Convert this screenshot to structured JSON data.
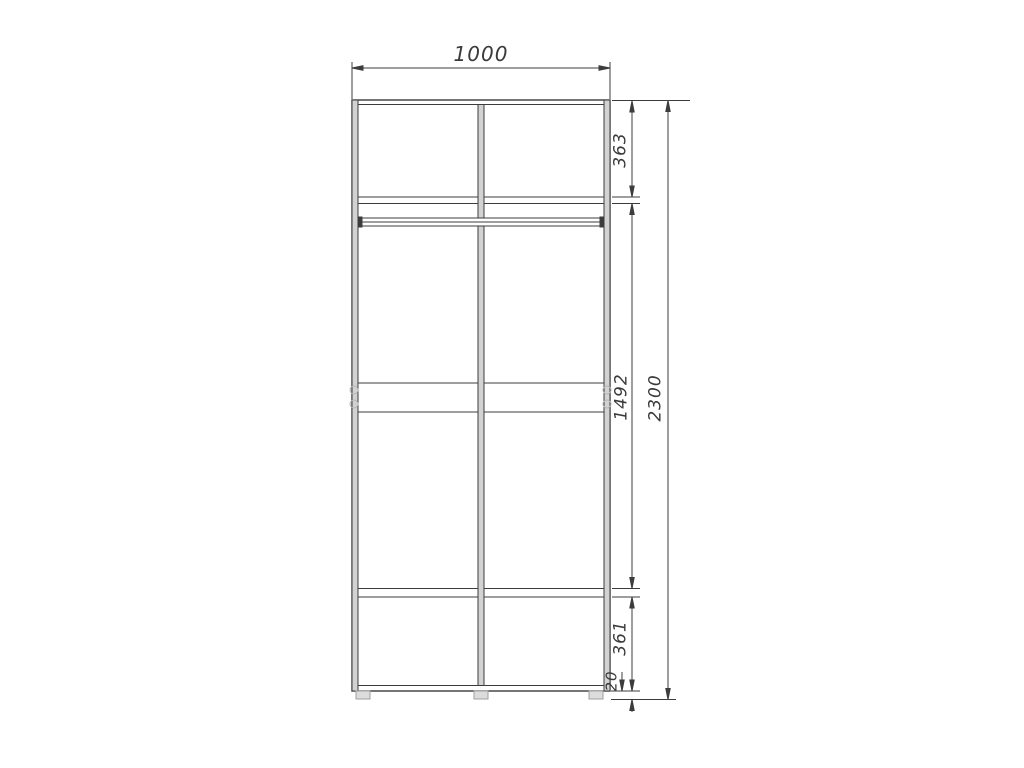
{
  "drawing": {
    "subject": "wardrobe-front-elevation-technical-drawing",
    "dims": {
      "width": "1000",
      "top_section": "363",
      "middle_section": "1492",
      "bottom_section": "361",
      "plinth": "20",
      "total_height": "2300"
    },
    "colors": {
      "line": "#3c3c3c",
      "panel_fill": "#d2d2d2",
      "fitting": "#b5b5b5",
      "foot_fill": "#dcdcdc",
      "background": "#ffffff"
    }
  }
}
